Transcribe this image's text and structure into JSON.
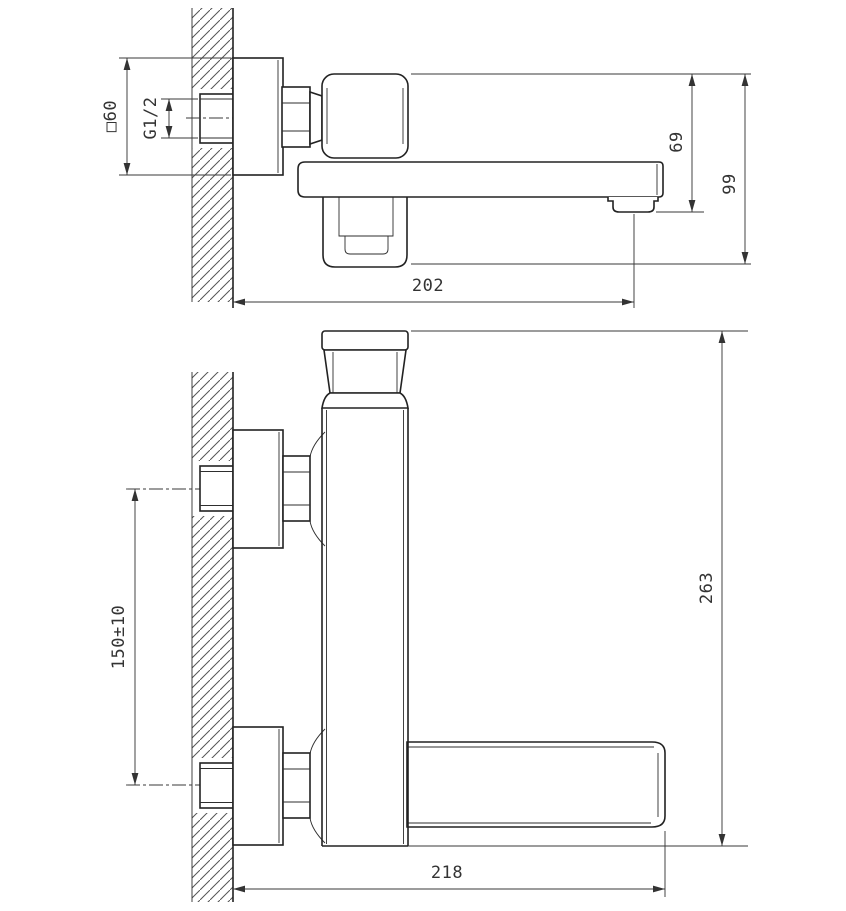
{
  "drawing": {
    "type": "faucet installation dimensional drawing",
    "colors": {
      "background": "#ffffff",
      "line": "#222222",
      "dimension": "#3a3a3a",
      "hatch": "#555555"
    }
  },
  "side_view": {
    "dimensions": {
      "flange_size": "□60",
      "thread_size": "G1/2",
      "spout_height": "69",
      "overall_height": "99",
      "spout_reach": "202"
    }
  },
  "front_view": {
    "dimensions": {
      "inlet_spacing": "150±10",
      "overall_height": "263",
      "overall_width": "218"
    }
  }
}
